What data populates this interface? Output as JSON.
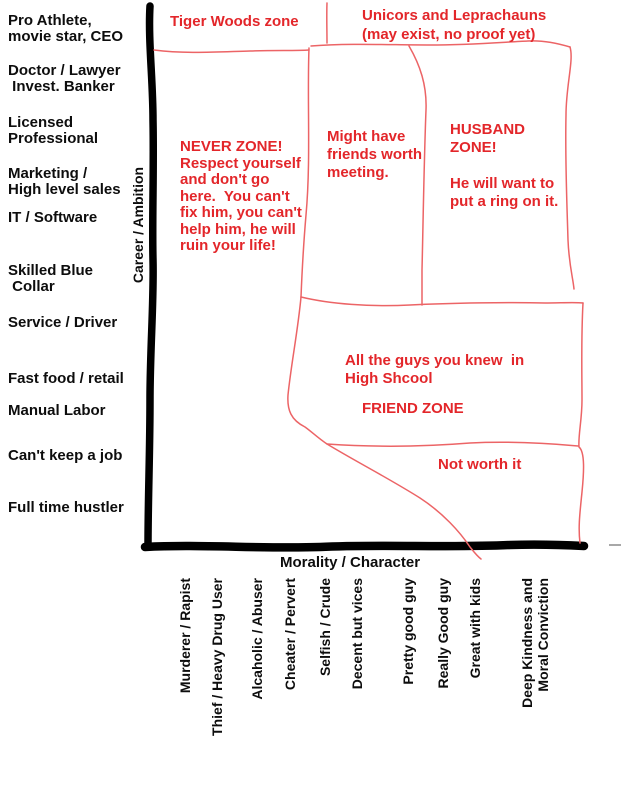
{
  "colors": {
    "red": "#e3262a",
    "redline": "#ec6466",
    "axis": "#000000",
    "ink": "#0d0d0d",
    "gray": "#a8a8a8"
  },
  "chart_data": {
    "type": "area",
    "title": "",
    "xlabel": "Morality / Character",
    "ylabel": "Career / Ambition",
    "x_categories": [
      "Murderer / Rapist",
      "Thief / Heavy Drug User",
      "Alcaholic / Abuser",
      "Cheater / Pervert",
      "Selfish / Crude",
      "Decent but vices",
      "Pretty good guy",
      "Really Good guy",
      "Great with kids",
      "Deep Kindness and\nMoral Conviction"
    ],
    "y_categories": [
      "Pro Athlete,\nmovie star, CEO",
      "Doctor / Lawyer\n Invest. Banker",
      "Licensed\nProfessional",
      "Marketing /\nHigh level sales",
      "IT / Software",
      "Skilled Blue\n Collar",
      "Service / Driver",
      "Fast food / retail",
      "Manual Labor",
      "Can't keep a job",
      "Full time hustler"
    ],
    "zones": [
      {
        "id": "tiger-woods-zone",
        "text": "Tiger Woods zone",
        "x_range": "Murderer / Rapist to Selfish / Crude",
        "y_range": "above Pro Athlete, movie star, CEO (off the top of the chart)"
      },
      {
        "id": "unicorns-leprachauns-zone",
        "text": "Unicors and Leprachauns\n(may exist, no proof yet)",
        "x_range": "Selfish / Crude to Deep Kindness and Moral Conviction",
        "y_range": "above Pro Athlete, movie star, CEO (off the top of the chart)"
      },
      {
        "id": "never-zone",
        "text": "NEVER ZONE!\nRespect yourself\nand don't go\nhere.  You can't\nfix him, you can't\nhelp him, he will\nruin your life!",
        "x_range": "Murderer / Rapist to Selfish / Crude",
        "y_range": "all career levels"
      },
      {
        "id": "might-have-friends-zone",
        "text": "Might have\nfriends worth\nmeeting.",
        "x_range": "Selfish / Crude to Pretty good guy",
        "y_range": "Pro Athlete, movie star, CEO to Service / Driver"
      },
      {
        "id": "husband-zone",
        "text": "HUSBAND\nZONE!\n\nHe will want to\nput a ring on it.",
        "x_range": "Pretty good guy to Deep Kindness and Moral Conviction",
        "y_range": "Pro Athlete, movie star, CEO to Skilled Blue Collar"
      },
      {
        "id": "friend-zone",
        "text": "All the guys you knew  in\nHigh Shcool",
        "title": "FRIEND ZONE",
        "x_range": "Selfish / Crude to Deep Kindness and Moral Conviction",
        "y_range": "Service / Driver to Can't keep a job"
      },
      {
        "id": "not-worth-it-zone",
        "text": "Not worth it",
        "x_range": "Pretty good guy to Deep Kindness and Moral Conviction",
        "y_range": "Can't keep a job to Full time hustler"
      }
    ]
  }
}
